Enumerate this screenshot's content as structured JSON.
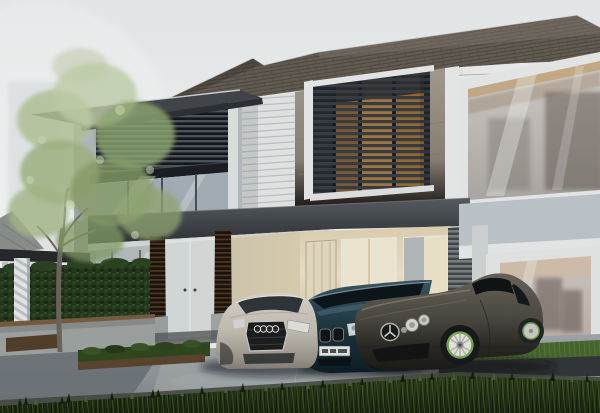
{
  "meta": {
    "width": 600,
    "height": 413,
    "kind": "3d-architectural-exterior-rendering",
    "time_of_day": "dusk"
  },
  "scene": {
    "sky": "pale hazy sky with faint ghosted high-rise silhouettes at upper left",
    "building": "modern two-storey house: dark shingle roof with deep eaves, taupe stucco upper wall with dark horizontal louver screen over warm wood, large white-framed picture windows, flat-roofed left wing with louvered balcony screen and glass curtain wall, glazed entrance with dark ribbed columns, integrated carport with warm lit cream interior, cream door and lit windows, grey slatted wall panel",
    "landscape": "leafy light-green tree, clipped dark hedge behind a low concrete wall with timber cap, small pergola with striped column, neighbouring hip roof at far left, concrete driveway with planting strip, bright grass verge at right, dark lawn in the foreground",
    "vehicles": [
      {
        "name": "audi-sedan",
        "body_color": "#cfc9bd",
        "position": "left, front three-quarter view",
        "details": "dark hexagonal single-frame grille with four-ring emblem, lit headlamps"
      },
      {
        "name": "bmw-coupe",
        "body_color": "#2b4a57",
        "position": "centre, nosing out of carport",
        "details": "twin kidney grilles, white licence plate with illegible characters"
      },
      {
        "name": "mercedes-slr-coupe",
        "body_color": "#4e4b43",
        "position": "right, long bonnet toward viewer",
        "details": "three-pointed-star grille badge, twin round headlamps, white wheels with green rim accent"
      }
    ]
  },
  "palette": {
    "sky_top": "#eef2f3",
    "sky_glow": "#fbfcfc",
    "roof_shingle": "#675f55",
    "roof_edge": "#3f3a34",
    "fascia": "#f2f4f4",
    "stucco": "#968d81",
    "trim": "#eff1f1",
    "louver_base": "#262b31",
    "louver_slat": "#383f47",
    "louver_wood": "#a87a3f",
    "balcony_screen": "#14171b",
    "balcony_slat": "#4d565e",
    "canopy_top": "#565b60",
    "canopy_bottom": "#303437",
    "clapboard": "#e9eceb",
    "glass_cool": "#a8b4bb",
    "mullion": "#47525a",
    "warm_interior": "#f2e7cb",
    "door_cream": "#eae0c8",
    "rib_column": "#1c120c",
    "pier": "#bcc2c6",
    "pier_base": "#9fa5a4",
    "hedge": "#24381e",
    "low_wall": "#a9aeac",
    "wall_cap": "#7b5f40",
    "pergola": "#27292b",
    "leaf_light": "#b7c89b",
    "leaf_mid": "#94ae77",
    "trunk": "#6e685e",
    "drive": "#9aa1a4",
    "drive_dark": "#6e757a",
    "strip_green": "#31481f",
    "mulch": "#5c4630",
    "curb": "#33373a",
    "lawn": "#2c3e20",
    "audi_silver": "#cfc9bd",
    "bmw_teal": "#2b4a57",
    "mercedes_grey": "#4e4b43",
    "wheel_white": "#ebece8",
    "wheel_green": "#79aa48",
    "window_haze": "#cfc6c0",
    "pillar": "#3a3d3f"
  }
}
